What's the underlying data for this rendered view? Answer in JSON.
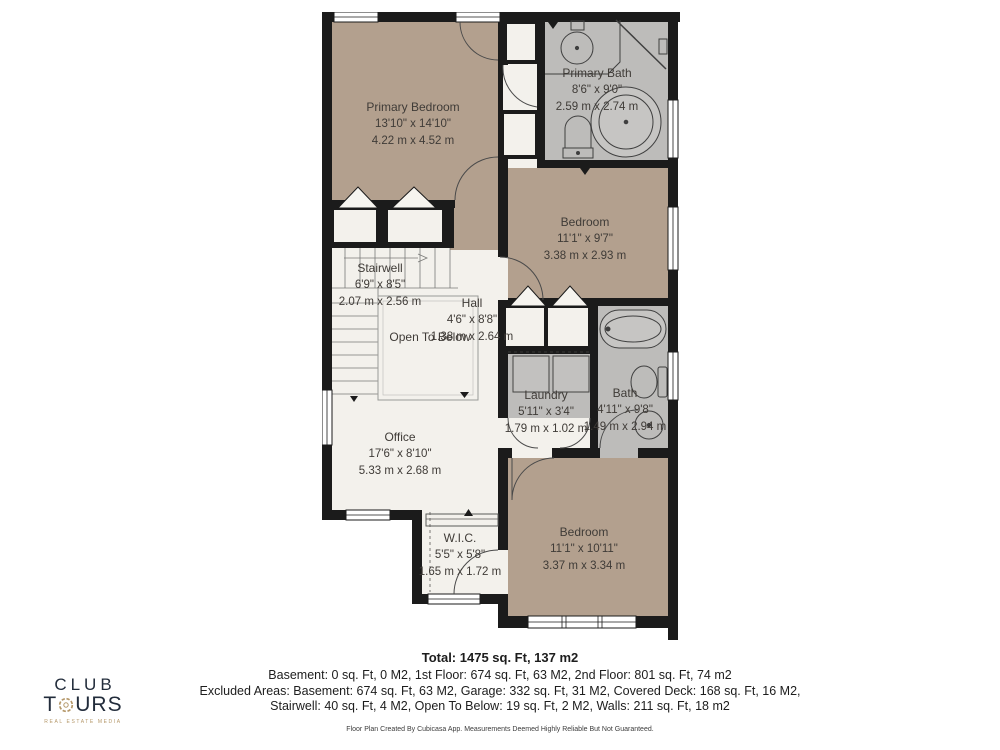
{
  "colors": {
    "wall": "#1b1b1b",
    "room_tan": "#b3a08e",
    "room_gray": "#bdbcba",
    "floor_white": "#f3f1ec",
    "logo_navy": "#222c3b",
    "logo_gold": "#b5986a"
  },
  "logo": {
    "club": "CLUB",
    "tours_t": "T",
    "tours_urs": "URS",
    "tagline": "REAL ESTATE MEDIA"
  },
  "rooms": [
    {
      "name": "Primary Bedroom",
      "imperial": "13'10\" x 14'10\"",
      "metric": "4.22 m x 4.52 m"
    },
    {
      "name": "Primary Bath",
      "imperial": "8'6\" x 9'0\"",
      "metric": "2.59 m x 2.74 m"
    },
    {
      "name": "Bedroom",
      "imperial": "11'1\" x 9'7\"",
      "metric": "3.38 m x 2.93 m"
    },
    {
      "name": "Stairwell",
      "imperial": "6'9\" x 8'5\"",
      "metric": "2.07 m x 2.56 m"
    },
    {
      "name": "Hall",
      "imperial": "4'6\" x 8'8\"",
      "metric": "1.38 m x 2.64 m"
    },
    {
      "name": "Open To Below"
    },
    {
      "name": "Laundry",
      "imperial": "5'11\" x 3'4\"",
      "metric": "1.79 m x 1.02 m"
    },
    {
      "name": "Bath",
      "imperial": "4'11\" x 9'8\"",
      "metric": "1.49 m x 2.94 m"
    },
    {
      "name": "Office",
      "imperial": "17'6\" x 8'10\"",
      "metric": "5.33 m x 2.68 m"
    },
    {
      "name": "W.I.C.",
      "imperial": "5'5\" x 5'8\"",
      "metric": "1.65 m x 1.72 m"
    },
    {
      "name": "Bedroom",
      "imperial": "11'1\" x 10'11\"",
      "metric": "3.37 m x 3.34 m"
    }
  ],
  "summary": {
    "total": "Total: 1475 sq. Ft, 137 m2",
    "line1": "Basement: 0 sq. Ft, 0 M2, 1st Floor: 674 sq. Ft, 63 M2, 2nd Floor: 801 sq. Ft, 74 m2",
    "line2": "Excluded Areas: Basement: 674 sq. Ft, 63 M2, Garage: 332 sq. Ft, 31 M2, Covered Deck: 168 sq. Ft, 16 M2,",
    "line3": "Stairwell: 40 sq. Ft, 4 M2, Open To Below: 19 sq. Ft, 2 M2, Walls: 211 sq. Ft, 18 m2"
  },
  "disclaimer": "Floor Plan Created By Cubicasa App. Measurements Deemed Highly Reliable But Not Guaranteed."
}
